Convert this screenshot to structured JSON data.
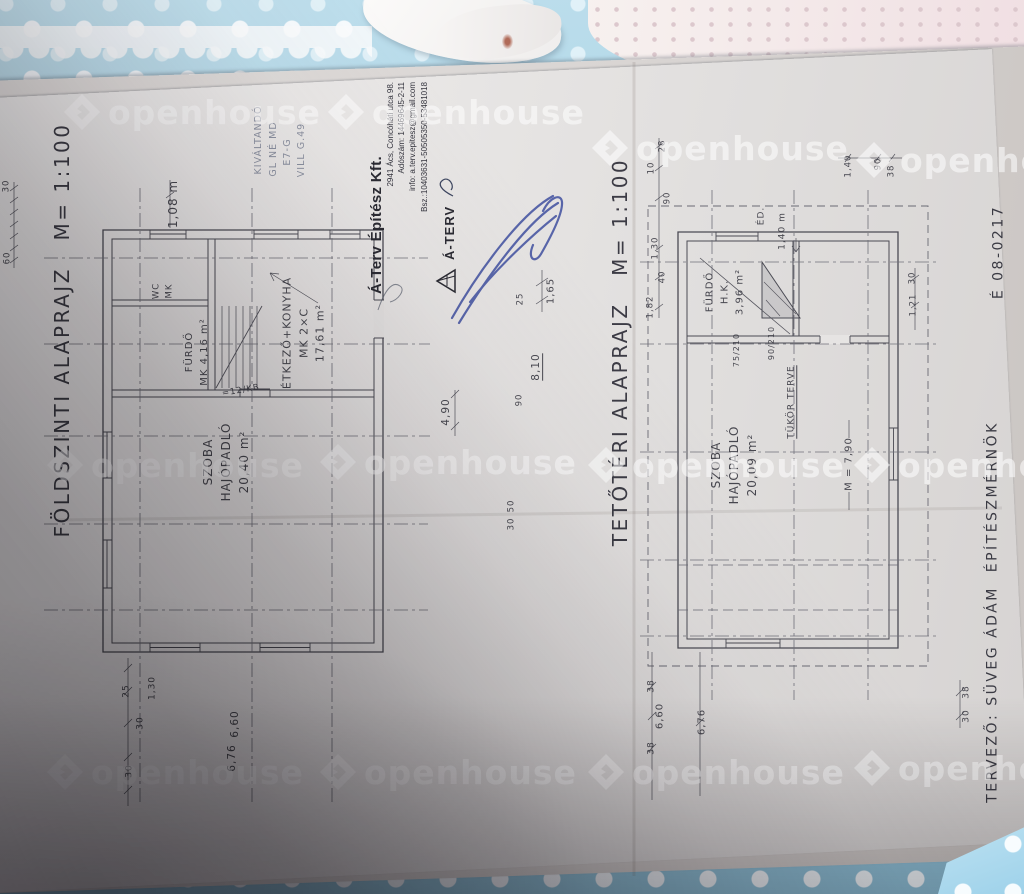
{
  "photo": {
    "watermark": {
      "text": "openhouse",
      "positions": [
        {
          "x": 62,
          "y": 92
        },
        {
          "x": 326,
          "y": 92
        },
        {
          "x": 590,
          "y": 128
        },
        {
          "x": 854,
          "y": 140
        },
        {
          "x": 45,
          "y": 445
        },
        {
          "x": 318,
          "y": 442
        },
        {
          "x": 586,
          "y": 445
        },
        {
          "x": 852,
          "y": 445
        },
        {
          "x": 45,
          "y": 752
        },
        {
          "x": 318,
          "y": 752
        },
        {
          "x": 586,
          "y": 752
        },
        {
          "x": 852,
          "y": 748
        }
      ]
    }
  },
  "document": {
    "stamp": {
      "company": "Á-Terv Építész Kft.",
      "lines": [
        "2941 Ács, Concóháti utca 98.",
        "Adószám: 14469645-2-11",
        "info: a.terv.epitesz@gmail.com",
        "Bsz.:10403631-50505350-53481018"
      ],
      "logo_text": "Á-TERV"
    },
    "annotations": [
      {
        "name": "title-ground-floor",
        "text": "FÖLDSZINTI ALAPRAJZ   M= 1:100",
        "x": 62,
        "y": 330,
        "size": 20,
        "cls": "ink title"
      },
      {
        "name": "title-attic",
        "text": "TETŐTÉRI ALAPRAJZ   M= 1:100",
        "x": 620,
        "y": 352,
        "size": 20,
        "cls": "ink title"
      },
      {
        "name": "designer-credit",
        "text": "TERVEZŐ: SÜVEG ÁDÁM  ÉPÍTÉSZMÉRNÖK",
        "x": 993,
        "y": 612,
        "size": 14,
        "cls": "ink title"
      },
      {
        "name": "license-number",
        "text": "É 08-0217",
        "x": 999,
        "y": 252,
        "size": 14,
        "cls": "ink title"
      },
      {
        "name": "room-label-szoba-gf",
        "lines": [
          "SZOBA",
          "HAJÓPADLÓ",
          "20,40 m²"
        ],
        "x": 226,
        "y": 462,
        "size": 12
      },
      {
        "name": "room-label-furdo-gf",
        "lines": [
          "FÜRDŐ",
          "MK 4,16 m²"
        ],
        "x": 197,
        "y": 352,
        "size": 10
      },
      {
        "name": "room-label-wc",
        "lines": [
          "WC",
          "MK"
        ],
        "x": 163,
        "y": 291,
        "size": 8.5
      },
      {
        "name": "room-label-etkezo",
        "lines": [
          "ÉTKEZŐ+KONYHA",
          "MK 2×C",
          "17,61 m²"
        ],
        "x": 304,
        "y": 333,
        "size": 11
      },
      {
        "name": "stair-note",
        "text": "=12/KB",
        "x": 241,
        "y": 391,
        "size": 8.5,
        "rot": -10
      },
      {
        "name": "dim",
        "text": "1,08 m",
        "x": 173,
        "y": 204,
        "size": 12
      },
      {
        "name": "pencil-note",
        "text": "KIVÁLTANDÓ",
        "x": 259,
        "y": 140,
        "size": 9.5,
        "cls": "pencil"
      },
      {
        "name": "pencil-note",
        "text": "GL NÉ MD",
        "x": 274,
        "y": 149,
        "size": 9.5,
        "cls": "pencil"
      },
      {
        "name": "pencil-note",
        "text": "E7-G",
        "x": 288,
        "y": 152,
        "size": 9.5,
        "cls": "pencil"
      },
      {
        "name": "pencil-note",
        "text": "VILL G.49",
        "x": 302,
        "y": 150,
        "size": 9.5,
        "cls": "pencil"
      },
      {
        "name": "dim",
        "text": "4,90",
        "x": 447,
        "y": 412,
        "size": 10.5
      },
      {
        "name": "dim",
        "text": "8,10",
        "x": 537,
        "y": 367,
        "size": 10.5,
        "underline": true
      },
      {
        "name": "dim",
        "text": "1,65",
        "x": 551,
        "y": 291,
        "size": 10
      },
      {
        "name": "dim",
        "text": "25",
        "x": 521,
        "y": 299,
        "size": 8.5
      },
      {
        "name": "dim",
        "text": "90",
        "x": 520,
        "y": 400,
        "size": 8.5
      },
      {
        "name": "dim",
        "text": "50",
        "x": 512,
        "y": 506,
        "size": 8.5
      },
      {
        "name": "dim",
        "text": "30",
        "x": 512,
        "y": 524,
        "size": 8.5
      },
      {
        "name": "dim",
        "text": "25",
        "x": 127,
        "y": 691,
        "size": 9
      },
      {
        "name": "dim",
        "text": "1,30",
        "x": 153,
        "y": 688,
        "size": 9
      },
      {
        "name": "dim",
        "text": "30",
        "x": 141,
        "y": 723,
        "size": 9
      },
      {
        "name": "dim",
        "text": "6,60",
        "x": 236,
        "y": 724,
        "size": 10.5
      },
      {
        "name": "dim",
        "text": "6,76",
        "x": 233,
        "y": 758,
        "size": 10.5
      },
      {
        "name": "dim",
        "text": "30",
        "x": 130,
        "y": 771,
        "size": 9
      },
      {
        "name": "dim",
        "text": "30",
        "x": 7,
        "y": 186,
        "size": 8.5
      },
      {
        "name": "dim",
        "text": "60",
        "x": 8,
        "y": 258,
        "size": 8.5
      },
      {
        "name": "room-label-szoba-attic",
        "lines": [
          "SZOBA",
          "HAJÓPADLÓ",
          "20,09 m²"
        ],
        "x": 734,
        "y": 465,
        "size": 12
      },
      {
        "name": "room-label-furdo-attic",
        "lines": [
          "FÜRDŐ",
          "H.K.",
          "3,96 m²"
        ],
        "x": 725,
        "y": 292,
        "size": 10
      },
      {
        "name": "mirror-plan-note",
        "text": "TÜKÖR TERVE",
        "x": 792,
        "y": 402,
        "size": 9,
        "underline": true
      },
      {
        "name": "height-note",
        "text": "M = 7,90",
        "x": 849,
        "y": 464,
        "size": 10
      },
      {
        "name": "north-note",
        "text": "ÉD.",
        "x": 762,
        "y": 216,
        "size": 9
      },
      {
        "name": "dim",
        "text": "1,40 m",
        "x": 783,
        "y": 231,
        "size": 9
      },
      {
        "name": "door-size",
        "text": "75/210",
        "x": 737,
        "y": 350,
        "size": 8
      },
      {
        "name": "door-size",
        "text": "90/210",
        "x": 772,
        "y": 343,
        "size": 8
      },
      {
        "name": "dim",
        "text": "1,40",
        "x": 849,
        "y": 166,
        "size": 8.5
      },
      {
        "name": "dim",
        "text": "90",
        "x": 879,
        "y": 164,
        "size": 8.5
      },
      {
        "name": "dim",
        "text": "38",
        "x": 892,
        "y": 171,
        "size": 8.5
      },
      {
        "name": "dim",
        "text": "28",
        "x": 663,
        "y": 146,
        "size": 8.5
      },
      {
        "name": "dim",
        "text": "10",
        "x": 652,
        "y": 168,
        "size": 8.5
      },
      {
        "name": "dim",
        "text": "90",
        "x": 668,
        "y": 198,
        "size": 8.5
      },
      {
        "name": "dim",
        "text": "1,30",
        "x": 656,
        "y": 248,
        "size": 8.5
      },
      {
        "name": "dim",
        "text": "40",
        "x": 663,
        "y": 277,
        "size": 8.5
      },
      {
        "name": "dim",
        "text": "1,82",
        "x": 651,
        "y": 307,
        "size": 8.5
      },
      {
        "name": "dim",
        "text": "1,21",
        "x": 914,
        "y": 305,
        "size": 8.5
      },
      {
        "name": "dim",
        "text": "30",
        "x": 913,
        "y": 278,
        "size": 8.5
      },
      {
        "name": "dim",
        "text": "38",
        "x": 652,
        "y": 686,
        "size": 9
      },
      {
        "name": "dim",
        "text": "6,60",
        "x": 660,
        "y": 716,
        "size": 10
      },
      {
        "name": "dim",
        "text": "38",
        "x": 652,
        "y": 748,
        "size": 9
      },
      {
        "name": "dim",
        "text": "6,76",
        "x": 702,
        "y": 722,
        "size": 10
      },
      {
        "name": "dim",
        "text": "38",
        "x": 967,
        "y": 692,
        "size": 9
      },
      {
        "name": "dim",
        "text": "30",
        "x": 967,
        "y": 716,
        "size": 9
      }
    ]
  }
}
